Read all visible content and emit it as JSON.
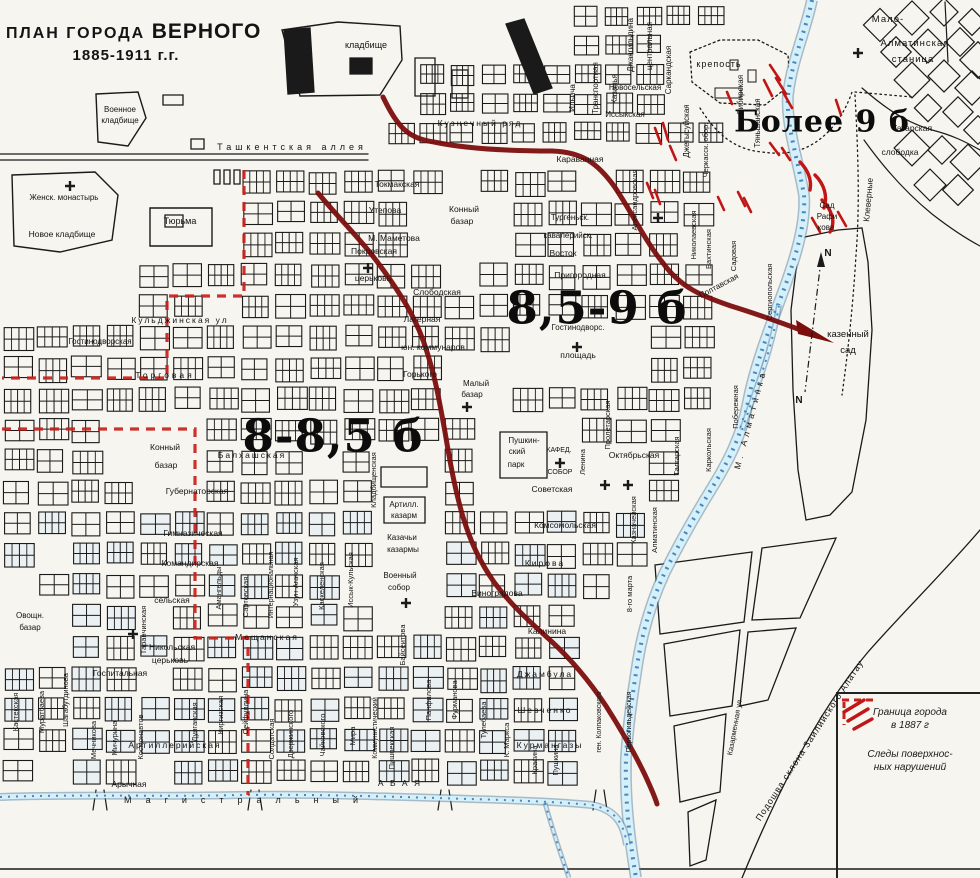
{
  "title": {
    "prefix": "ПЛАН ГОРОДА",
    "city": "ВЕРНОГО",
    "years": "1885-1911 г.г."
  },
  "zones": [
    {
      "label": "Более 9 б"
    },
    {
      "label": "8,5-9 б"
    },
    {
      "label": "8-8,5 б"
    }
  ],
  "legend": {
    "items": [
      {
        "symbol": "boundary-dash-icon",
        "lines": [
          "Граница города",
          "в 1887 г"
        ]
      },
      {
        "symbol": "surface-hatch-icon",
        "lines": [
          "Следы поверхнос-",
          "ных нарушений"
        ]
      }
    ]
  },
  "colors": {
    "paper": "#f7f5ef",
    "ink": "#1a1a1a",
    "red_curve": "#7c0e0e",
    "red_boundary": "#c8201c",
    "red_hatch": "#c01616",
    "blue_dark": "#2f74b5",
    "blue_mid": "#56809f",
    "blue_light": "#d6f0fa"
  },
  "map": {
    "labels": [
      {
        "t": "кладбище",
        "x": 366,
        "y": 48,
        "s": 9
      },
      {
        "t": "Военное",
        "x": 120,
        "y": 112,
        "s": 8
      },
      {
        "t": "кладбище",
        "x": 120,
        "y": 123,
        "s": 8
      },
      {
        "t": "Ташкентская  аллея",
        "x": 292,
        "y": 150,
        "s": 9,
        "sp": 4
      },
      {
        "t": "Кузнечный ряд",
        "x": 480,
        "y": 126,
        "s": 8.5,
        "sp": 2
      },
      {
        "t": "Женск.  монастырь",
        "x": 64,
        "y": 200,
        "s": 8
      },
      {
        "t": "Новое кладбище",
        "x": 62,
        "y": 237,
        "s": 8.5
      },
      {
        "t": "Тюрьма",
        "x": 180,
        "y": 224,
        "s": 9
      },
      {
        "t": "Токмакская",
        "x": 397,
        "y": 187,
        "s": 8.5
      },
      {
        "t": "Утепова",
        "x": 385,
        "y": 213,
        "s": 8.5
      },
      {
        "t": "Конный",
        "x": 464,
        "y": 212,
        "s": 8.5
      },
      {
        "t": "базар",
        "x": 462,
        "y": 224,
        "s": 8.5
      },
      {
        "t": "М. Маметова",
        "x": 394,
        "y": 241,
        "s": 8.5
      },
      {
        "t": "Покровская",
        "x": 374,
        "y": 254,
        "s": 8.5
      },
      {
        "t": "церьковь",
        "x": 373,
        "y": 281,
        "s": 8.5
      },
      {
        "t": "Слободская",
        "x": 437,
        "y": 295,
        "s": 8.5
      },
      {
        "t": "Лагерная",
        "x": 422,
        "y": 322,
        "s": 8.5
      },
      {
        "t": "юн. коммунаров",
        "x": 433,
        "y": 350,
        "s": 8.5
      },
      {
        "t": "Горького",
        "x": 420,
        "y": 377,
        "s": 8.5
      },
      {
        "t": "Малый",
        "x": 476,
        "y": 386,
        "s": 8
      },
      {
        "t": "базар",
        "x": 472,
        "y": 397,
        "s": 8
      },
      {
        "t": "Кульджинская ул",
        "x": 180,
        "y": 323,
        "s": 8.5,
        "sp": 2
      },
      {
        "t": "Гостинодворская",
        "x": 100,
        "y": 344,
        "s": 8
      },
      {
        "t": "Торговая",
        "x": 165,
        "y": 378,
        "s": 8.5,
        "sp": 3
      },
      {
        "t": "Конный",
        "x": 165,
        "y": 450,
        "s": 8.5
      },
      {
        "t": "базар",
        "x": 166,
        "y": 468,
        "s": 8.5
      },
      {
        "t": "Балхашская",
        "x": 252,
        "y": 458,
        "s": 8.5,
        "sp": 2
      },
      {
        "t": "Губернаторская",
        "x": 197,
        "y": 494,
        "s": 8.5
      },
      {
        "t": "Гимназическая",
        "x": 193,
        "y": 536,
        "s": 8.5
      },
      {
        "t": "Командирская",
        "x": 190,
        "y": 566,
        "s": 8.5
      },
      {
        "t": "сельская",
        "x": 172,
        "y": 603,
        "s": 8.5
      },
      {
        "t": "Никольская",
        "x": 172,
        "y": 650,
        "s": 8.5
      },
      {
        "t": "церьковь",
        "x": 170,
        "y": 663,
        "s": 8.5
      },
      {
        "t": "Мещанская",
        "x": 267,
        "y": 640,
        "s": 8.5,
        "sp": 2
      },
      {
        "t": "Овощн.",
        "x": 30,
        "y": 618,
        "s": 8
      },
      {
        "t": "базар",
        "x": 30,
        "y": 630,
        "s": 8
      },
      {
        "t": "Госпитальная",
        "x": 120,
        "y": 676,
        "s": 8.5
      },
      {
        "t": "Артиллерийская",
        "x": 175,
        "y": 748,
        "s": 8.5,
        "sp": 2
      },
      {
        "t": "Арычная",
        "x": 129,
        "y": 787,
        "s": 8.5
      },
      {
        "t": "Пригородная",
        "x": 580,
        "y": 278,
        "s": 8.5
      },
      {
        "t": "Гостинодворс.",
        "x": 578,
        "y": 330,
        "s": 8
      },
      {
        "t": "площадь",
        "x": 578,
        "y": 358,
        "s": 8.5
      },
      {
        "t": "Тургеньск.",
        "x": 570,
        "y": 220,
        "s": 8
      },
      {
        "t": "кавалерийск.",
        "x": 568,
        "y": 238,
        "s": 8
      },
      {
        "t": "Восток",
        "x": 563,
        "y": 256,
        "s": 8.5
      },
      {
        "t": "Караванная",
        "x": 580,
        "y": 162,
        "s": 8.5
      },
      {
        "t": "Новосельская",
        "x": 635,
        "y": 90,
        "s": 8
      },
      {
        "t": "Иссыкская",
        "x": 625,
        "y": 117,
        "s": 8
      },
      {
        "t": "крепость",
        "x": 719,
        "y": 67,
        "s": 9,
        "sp": 1
      },
      {
        "t": "Мало-",
        "x": 888,
        "y": 22,
        "s": 9.5,
        "sp": 1
      },
      {
        "t": "Алматинская",
        "x": 915,
        "y": 46,
        "s": 9.5,
        "sp": 1
      },
      {
        "t": "станица",
        "x": 913,
        "y": 62,
        "s": 9.5,
        "sp": 1
      },
      {
        "t": "Татарская",
        "x": 912,
        "y": 131,
        "s": 8.5
      },
      {
        "t": "слободка",
        "x": 900,
        "y": 155,
        "s": 8.5
      },
      {
        "t": "Сад",
        "x": 827,
        "y": 208,
        "s": 8
      },
      {
        "t": "Рафи",
        "x": 827,
        "y": 219,
        "s": 8
      },
      {
        "t": "кова",
        "x": 826,
        "y": 230,
        "s": 8
      },
      {
        "t": "казенный",
        "x": 848,
        "y": 337,
        "s": 9.5
      },
      {
        "t": "сад",
        "x": 848,
        "y": 353,
        "s": 9.5
      },
      {
        "t": "Октябрьская",
        "x": 634,
        "y": 458,
        "s": 8.5
      },
      {
        "t": "Советская",
        "x": 552,
        "y": 492,
        "s": 8.5
      },
      {
        "t": "Комсомольская",
        "x": 565,
        "y": 528,
        "s": 8.5
      },
      {
        "t": "Кирова",
        "x": 545,
        "y": 566,
        "s": 8.5,
        "sp": 2
      },
      {
        "t": "Пушкин-",
        "x": 524,
        "y": 443,
        "s": 8
      },
      {
        "t": "ский",
        "x": 517,
        "y": 454,
        "s": 8
      },
      {
        "t": "парк",
        "x": 516,
        "y": 467,
        "s": 8
      },
      {
        "t": "КАФЕД.",
        "x": 559,
        "y": 452,
        "s": 7
      },
      {
        "t": "СОБОР",
        "x": 560,
        "y": 474,
        "s": 7
      },
      {
        "t": "Виноградова",
        "x": 497,
        "y": 596,
        "s": 8.5
      },
      {
        "t": "Калинина",
        "x": 547,
        "y": 634,
        "s": 8.5
      },
      {
        "t": "Джамбула",
        "x": 545,
        "y": 677,
        "s": 8.5,
        "sp": 2
      },
      {
        "t": "Шевченко",
        "x": 545,
        "y": 713,
        "s": 8.5,
        "sp": 2
      },
      {
        "t": "Курмангазы",
        "x": 550,
        "y": 748,
        "s": 8.5,
        "sp": 2
      },
      {
        "t": "А Б А Я",
        "x": 400,
        "y": 786,
        "s": 8.5,
        "sp": 2
      },
      {
        "t": "Казачьи",
        "x": 402,
        "y": 540,
        "s": 8
      },
      {
        "t": "казармы",
        "x": 403,
        "y": 552,
        "s": 8
      },
      {
        "t": "Военный",
        "x": 400,
        "y": 578,
        "s": 8
      },
      {
        "t": "собор",
        "x": 399,
        "y": 590,
        "s": 8
      },
      {
        "t": "Артилл.",
        "x": 404,
        "y": 507,
        "s": 8
      },
      {
        "t": "казарм",
        "x": 404,
        "y": 518,
        "s": 8
      },
      {
        "t": "Ильича",
        "x": 575,
        "y": 98,
        "r": -90,
        "s": 8
      },
      {
        "t": "Транспортная",
        "x": 598,
        "y": 88,
        "r": -90,
        "s": 8
      },
      {
        "t": "Казачья",
        "x": 617,
        "y": 89,
        "r": -90,
        "s": 8
      },
      {
        "t": "Джангильдина",
        "x": 633,
        "y": 45,
        "r": -90,
        "s": 8
      },
      {
        "t": "центральная",
        "x": 652,
        "y": 46,
        "r": -90,
        "s": 8
      },
      {
        "t": "Саркандская",
        "x": 671,
        "y": 70,
        "r": -90,
        "s": 8
      },
      {
        "t": "Джетысуйская",
        "x": 689,
        "y": 131,
        "r": -90,
        "s": 8
      },
      {
        "t": "Черкасск. обор.",
        "x": 708,
        "y": 150,
        "r": -90,
        "s": 7.5
      },
      {
        "t": "Сибирская",
        "x": 743,
        "y": 95,
        "r": -90,
        "s": 8
      },
      {
        "t": "Тяньшанская",
        "x": 760,
        "y": 123,
        "r": -90,
        "s": 8
      },
      {
        "t": "Клеверные",
        "x": 871,
        "y": 200,
        "r": -85,
        "s": 8.5
      },
      {
        "t": "Александровская",
        "x": 637,
        "y": 200,
        "r": -90,
        "s": 7.5
      },
      {
        "t": "Николаевская",
        "x": 696,
        "y": 235,
        "r": -90,
        "s": 7.5
      },
      {
        "t": "Бахтинская",
        "x": 711,
        "y": 249,
        "r": -90,
        "s": 7.5
      },
      {
        "t": "Садовая",
        "x": 736,
        "y": 256,
        "r": -90,
        "s": 7.5
      },
      {
        "t": "Полтавская",
        "x": 720,
        "y": 288,
        "r": -28,
        "s": 8
      },
      {
        "t": "Побережная",
        "x": 738,
        "y": 407,
        "r": -90,
        "s": 7.5
      },
      {
        "t": "Сергиопольская",
        "x": 772,
        "y": 292,
        "r": -90,
        "s": 7.5
      },
      {
        "t": "Казначейская",
        "x": 636,
        "y": 520,
        "r": -90,
        "s": 7.5
      },
      {
        "t": "Алматинская",
        "x": 657,
        "y": 530,
        "r": -90,
        "s": 7.5
      },
      {
        "t": "Талгарская",
        "x": 679,
        "y": 456,
        "r": -90,
        "s": 7.5
      },
      {
        "t": "Каркольская",
        "x": 711,
        "y": 450,
        "r": -90,
        "s": 7.5
      },
      {
        "t": "Ленина",
        "x": 585,
        "y": 462,
        "r": -90,
        "s": 7.5
      },
      {
        "t": "Пролетарская",
        "x": 610,
        "y": 425,
        "r": -90,
        "s": 7.5
      },
      {
        "t": "М. Алматинка",
        "x": 753,
        "y": 420,
        "r": -75,
        "s": 8.5,
        "sp": 4
      },
      {
        "t": "Кладбищенская",
        "x": 376,
        "y": 480,
        "r": -90,
        "s": 7.5
      },
      {
        "t": "Таранчинская",
        "x": 146,
        "y": 630,
        "r": -90,
        "s": 7.5
      },
      {
        "t": "Амангельды",
        "x": 221,
        "y": 588,
        "r": -90,
        "s": 7.5
      },
      {
        "t": "Сартовская",
        "x": 248,
        "y": 597,
        "r": -90,
        "s": 7.5
      },
      {
        "t": "Интернациональная",
        "x": 273,
        "y": 585,
        "r": -90,
        "s": 7
      },
      {
        "t": "Узун-Агачская",
        "x": 298,
        "y": 582,
        "r": -90,
        "s": 7.5
      },
      {
        "t": "Каскеленская",
        "x": 324,
        "y": 586,
        "r": -90,
        "s": 7.5
      },
      {
        "t": "Иссык-Кульская",
        "x": 353,
        "y": 580,
        "r": -90,
        "s": 7.5
      },
      {
        "t": "Кастекская",
        "x": 18,
        "y": 712,
        "r": -90,
        "s": 7.5
      },
      {
        "t": "Муратбаева",
        "x": 44,
        "y": 712,
        "r": -90,
        "s": 7.5
      },
      {
        "t": "Шагабутдинова",
        "x": 68,
        "y": 700,
        "r": -90,
        "s": 7.5
      },
      {
        "t": "Мечникова",
        "x": 96,
        "y": 740,
        "r": -90,
        "s": 7.5
      },
      {
        "t": "Мичурина",
        "x": 117,
        "y": 738,
        "r": -90,
        "s": 7.5
      },
      {
        "t": "Космонавтов",
        "x": 143,
        "y": 737,
        "r": -90,
        "s": 7.5
      },
      {
        "t": "Дунганская",
        "x": 197,
        "y": 722,
        "r": -90,
        "s": 7.5
      },
      {
        "t": "Киргизская",
        "x": 223,
        "y": 715,
        "r": -90,
        "s": 7.5
      },
      {
        "t": "Сейфуллина",
        "x": 248,
        "y": 712,
        "r": -90,
        "s": 7.5
      },
      {
        "t": "Солдатская",
        "x": 274,
        "y": 739,
        "r": -90,
        "s": 7.5
      },
      {
        "t": "Дзержинского",
        "x": 293,
        "y": 734,
        "r": -90,
        "s": 7.5
      },
      {
        "t": "Чайковского",
        "x": 325,
        "y": 735,
        "r": -90,
        "s": 7.5
      },
      {
        "t": "Мира",
        "x": 355,
        "y": 736,
        "r": -90,
        "s": 7.5
      },
      {
        "t": "Коммунистический",
        "x": 377,
        "y": 728,
        "r": -90,
        "s": 7
      },
      {
        "t": "Пишпекская",
        "x": 394,
        "y": 748,
        "r": -90,
        "s": 7.5
      },
      {
        "t": "Байсеитова",
        "x": 405,
        "y": 645,
        "r": -90,
        "s": 7.5
      },
      {
        "t": "Панфилова",
        "x": 431,
        "y": 700,
        "r": -90,
        "s": 7.5
      },
      {
        "t": "Фурманова",
        "x": 457,
        "y": 700,
        "r": -90,
        "s": 7.5
      },
      {
        "t": "Тулебаева",
        "x": 486,
        "y": 720,
        "r": -90,
        "s": 7.5
      },
      {
        "t": "К. Маркса",
        "x": 509,
        "y": 740,
        "r": -90,
        "s": 7.5
      },
      {
        "t": "Красина",
        "x": 537,
        "y": 760,
        "r": -90,
        "s": 7.5
      },
      {
        "t": "Пушкина",
        "x": 558,
        "y": 760,
        "r": -90,
        "s": 7.5
      },
      {
        "t": "ген. Колпаковского",
        "x": 601,
        "y": 722,
        "r": -90,
        "s": 7
      },
      {
        "t": "Первогильдейская",
        "x": 631,
        "y": 722,
        "r": -90,
        "s": 7
      },
      {
        "t": "8-го марта",
        "x": 632,
        "y": 594,
        "r": -90,
        "s": 7.5
      },
      {
        "t": "Казарменная ул",
        "x": 737,
        "y": 728,
        "r": -80,
        "s": 7.5
      },
      {
        "t": "Подошва склона Заилийского Алатау",
        "x": 812,
        "y": 742,
        "r": -57,
        "s": 9,
        "sp": 1
      },
      {
        "t": "Магистральный",
        "x": 248,
        "y": 803,
        "s": 9,
        "sp": 14
      },
      {
        "t": "N",
        "x": 828,
        "y": 256,
        "s": 10,
        "b": 1
      },
      {
        "t": "N",
        "x": 799,
        "y": 403,
        "s": 10,
        "b": 1
      }
    ]
  }
}
